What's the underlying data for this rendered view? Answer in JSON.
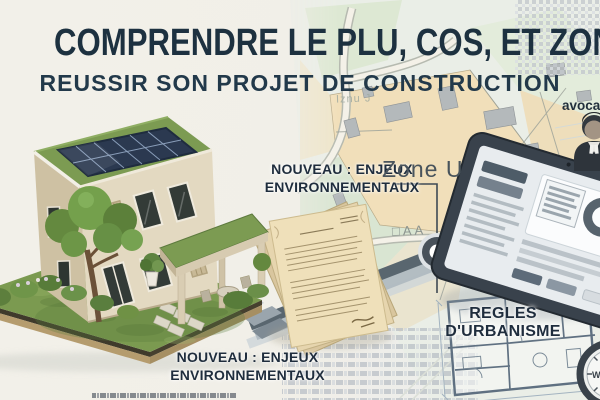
{
  "page": {
    "title": "COMPRENDRE LE PLU, COS, ET ZONES",
    "subtitle": "REUSSIR SON PROJET DE CONSTRUCTION"
  },
  "callouts": {
    "environment_top": {
      "line1": "NOUVEAU : ENJEUX",
      "line2": "ENVIRONNEMENTAUX"
    },
    "environment_bottom": {
      "line1": "NOUVEAU : ENJEUX",
      "line2": "ENVIRONNEMENTAUX"
    },
    "urbanism_rules": "REGLES D'URBANISME",
    "lawyer": "avocat"
  },
  "map": {
    "zone_label": "Zone U",
    "parcel_label": "□AA",
    "faint_label": "Iznu J"
  },
  "compass": {
    "west_label": "W"
  },
  "colors": {
    "title_navy": "#1d3140",
    "background": "#f1efe8",
    "map_zone_beige": "#f1dfba",
    "map_green": "#dde8d3",
    "road_gray": "#59666f",
    "tablet_frame": "#39424c",
    "grass_green": "#7b9a50",
    "parchment": "#efe0ba",
    "blueprint_line": "#5f7081"
  }
}
